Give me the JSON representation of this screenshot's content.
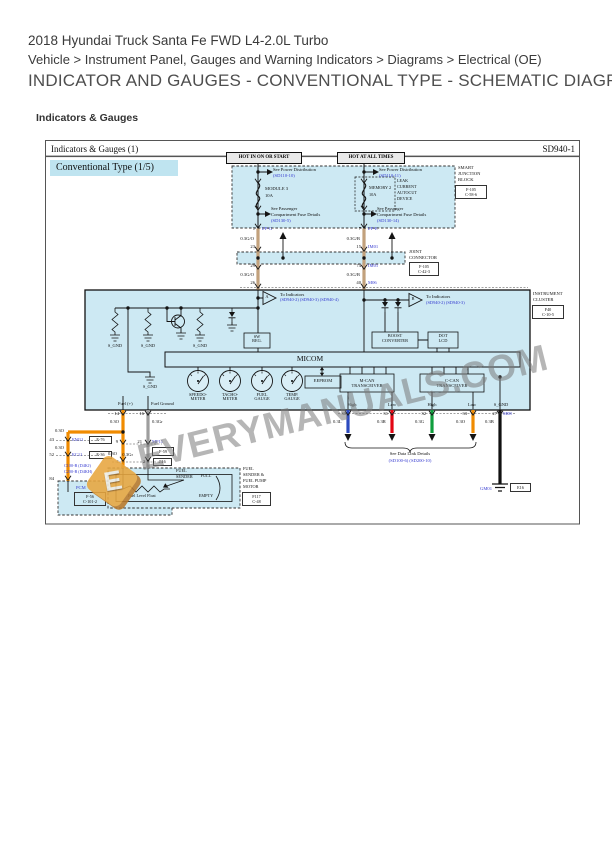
{
  "header": {
    "vehicle_title": "2018 Hyundai Truck Santa Fe FWD L4-2.0L Turbo",
    "breadcrumb": "Vehicle > Instrument Panel, Gauges and Warning Indicators > Diagrams > Electrical (OE)",
    "heading": "INDICATOR AND GAUGES - CONVENTIONAL TYPE - SCHEMATIC DIAGRAMS",
    "section_label": "Indicators & Gauges"
  },
  "sheet": {
    "title": "Indicators & Gauges (1)",
    "code": "SD940-1",
    "variant": "Conventional Type (1/5)"
  },
  "refs": {
    "power_dist": "See Power Distribution",
    "pd_left": "(SD110-10)",
    "pd_right": "(SD110-11)",
    "see_passenger": "See Passenger",
    "comp_fuse": "Compartment Fuse Details",
    "cf_left": "(SD130-5)",
    "cf_right": "(SD130-14)",
    "to_indicators": "To Indicators",
    "ind_a": "(SD940-2) (SD940-3) (SD940-4)",
    "ind_b": "(SD940-2) (SD940-3)",
    "data_link": "See Data Link Details",
    "data_link_codes": "(SD100-6) (SD200-10)"
  },
  "power": {
    "tag_left": "HOT IN ON OR START",
    "tag_right": "HOT AT ALL TIMES",
    "fuse_left_name": "MODULE 3",
    "fuse_right_name": "MEMORY 2",
    "amp": "10A",
    "leak": [
      "LEAK",
      "CURRENT",
      "AUTOCUT",
      "DEVICE"
    ]
  },
  "sjb": {
    "lines": [
      "SMART",
      "JUNCTION",
      "BLOCK"
    ],
    "codes": [
      "F-105",
      "C-58-6"
    ]
  },
  "joint": {
    "lines": [
      "JOINT",
      "CONNECTOR"
    ],
    "codes": [
      "F-105",
      "C-42-3"
    ]
  },
  "cluster": {
    "lines": [
      "INSTRUMENT",
      "CLUSTER"
    ],
    "codes": [
      "F40",
      "C-10-5"
    ],
    "micom": "MICOM",
    "eeprom": "EEPROM",
    "s_gnd": "S_GND",
    "sw_reg": [
      "SW",
      "REG."
    ],
    "boost": [
      "BOOST",
      "CONVERTER"
    ],
    "dot_lcd": [
      "DOT",
      "LCD"
    ],
    "mcan": [
      "M-CAN",
      "TRANSCEIVER"
    ],
    "ccan": [
      "C-CAN",
      "TRANSCEIVER"
    ],
    "tri_a": "A",
    "tri_b": "B",
    "gauges": [
      [
        "SPEEDO-",
        "METER"
      ],
      [
        "TACHO-",
        "METER"
      ],
      [
        "FUEL",
        "GAUGE"
      ],
      [
        "TEMP.",
        "GAUGE"
      ]
    ],
    "fuel_plus": "Fuel (+)",
    "fuel_ground": "Fuel Ground",
    "high": "High",
    "low": "Low"
  },
  "wires": {
    "go": "0.3G/O",
    "gb": "0.3G/B",
    "o": "0.3O",
    "gr": "0.3Gr",
    "l": "0.3L",
    "r": "0.3R",
    "g": "0.3G",
    "b": "0.3B"
  },
  "pins": {
    "sjb_l": "1",
    "sjb_r": "7",
    "jl_in": "23",
    "jl_out": "29",
    "cl_l": "26",
    "jr_in": "15",
    "jr_out": "74",
    "cl_r": "40",
    "fuel_p": "14",
    "fuel_g": "16",
    "s9": "9",
    "s21": "21",
    "s1": "1",
    "s2": "2",
    "b43": "43",
    "b52": "52",
    "b84": "84",
    "can1": "30",
    "can2": "31",
    "can3": "32",
    "can4": "33",
    "sg": "27"
  },
  "conns": {
    "ipg": "I/P-G",
    "ipe": "I/P-E",
    "im01": "IM01",
    "m06": "M06",
    "m08": "M08",
    "mf11": "MF11",
    "mf11_box": "F-59",
    "em11": "EM11",
    "em11_box": "E-76",
    "ec11": "EC11",
    "ec11_box": "E-36",
    "c100": "C100-B (D4KJ)",
    "c200": "C200-B (D4KH)",
    "f16": "F16",
    "gm01": "GM01",
    "gm01_box": "E16"
  },
  "pcm": {
    "name": "PCM",
    "codes": [
      "F-56",
      "C-101-2"
    ]
  },
  "fuel_sender": {
    "inner": [
      "FUEL",
      "SENDER"
    ],
    "full": "FULL",
    "empty": "EMPTY",
    "float_label": "Fuel Level Float",
    "side": [
      "FUEL",
      "SENDER &",
      "FUEL PUMP",
      "MOTOR"
    ],
    "codes": [
      "F117",
      "C-48"
    ]
  },
  "watermark": {
    "text": "EVERYMANUALS.COM",
    "logo_letter": "E"
  },
  "colors": {
    "diagram_blue": "#cde9f3",
    "wire_tan": "#c2a17c",
    "wire_orange": "#f08b00",
    "wire_gray": "#9e9e9e",
    "wire_blue": "#2d4bbf",
    "wire_red": "#e30613",
    "wire_green": "#109e3e",
    "wire_black": "#111111",
    "ref_blue": "#3338cf"
  }
}
